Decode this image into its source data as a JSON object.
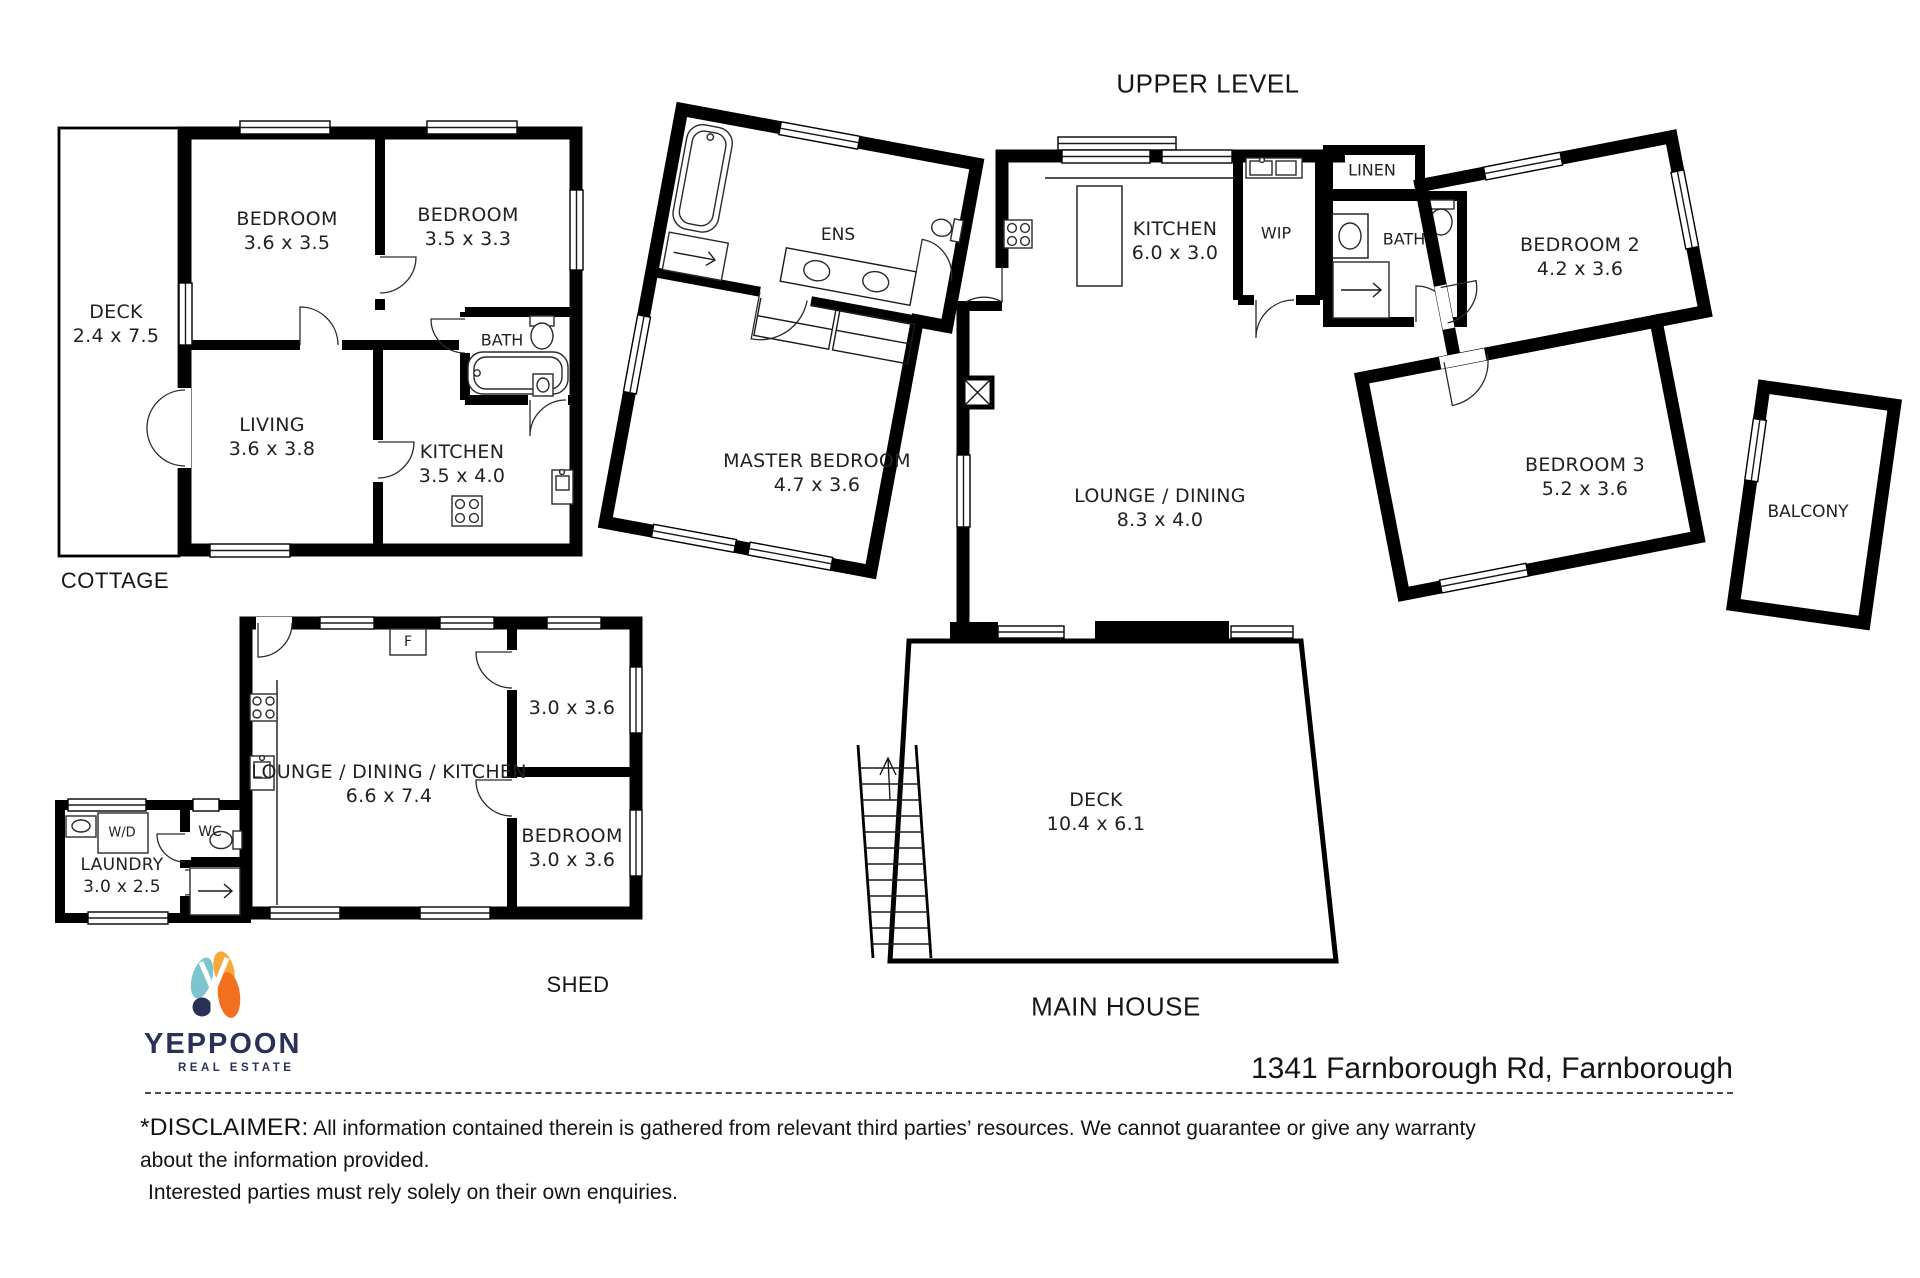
{
  "title": {
    "upper_level": "UPPER LEVEL"
  },
  "colors": {
    "wall": "#000000",
    "logo_navy": "#2b3057",
    "logo_teal": "#7cc5cf",
    "logo_orange": "#f2701f",
    "logo_orange_light": "#f7a83d"
  },
  "cottage": {
    "label": "COTTAGE",
    "rooms": [
      {
        "name": "DECK",
        "dims": "2.4 x 7.5"
      },
      {
        "name": "BEDROOM",
        "dims": "3.6 x 3.5"
      },
      {
        "name": "BEDROOM",
        "dims": "3.5 x 3.3"
      },
      {
        "name": "LIVING",
        "dims": "3.6 x 3.8"
      },
      {
        "name": "KITCHEN",
        "dims": "3.5 x 4.0"
      },
      {
        "name": "BATH"
      }
    ]
  },
  "shed": {
    "label": "SHED",
    "rooms": [
      {
        "name": "LOUNGE / DINING / KITCHEN",
        "dims": "6.6 x 7.4"
      },
      {
        "name": "",
        "dims": "3.0 x 3.6"
      },
      {
        "name": "BEDROOM",
        "dims": "3.0 x 3.6"
      },
      {
        "name": "LAUNDRY",
        "dims": "3.0 x 2.5"
      },
      {
        "name": "WC"
      },
      {
        "name": "W/D"
      },
      {
        "name": "F"
      }
    ]
  },
  "main_house": {
    "label": "MAIN HOUSE",
    "rooms": [
      {
        "name": "KITCHEN",
        "dims": "6.0 x 3.0"
      },
      {
        "name": "WIP"
      },
      {
        "name": "LINEN"
      },
      {
        "name": "BATH"
      },
      {
        "name": "ENS"
      },
      {
        "name": "MASTER BEDROOM",
        "dims": "4.7 x 3.6"
      },
      {
        "name": "BEDROOM 2",
        "dims": "4.2 x 3.6"
      },
      {
        "name": "BEDROOM 3",
        "dims": "5.2 x 3.6"
      },
      {
        "name": "LOUNGE / DINING",
        "dims": "8.3 x 4.0"
      },
      {
        "name": "BALCONY"
      },
      {
        "name": "DECK",
        "dims": "10.4 x 6.1"
      }
    ]
  },
  "footer": {
    "brand": "YEPPOON",
    "brand_sub": "REAL ESTATE",
    "address": "1341 Farnborough Rd, Farnborough",
    "disclaimer_prefix": "*DISCLAIMER:",
    "disclaimer_line1": "All information contained therein is gathered from relevant third parties’ resources. We cannot guarantee or give any warranty about the information provided.",
    "disclaimer_line2": "Interested parties must rely solely on their own enquiries."
  }
}
